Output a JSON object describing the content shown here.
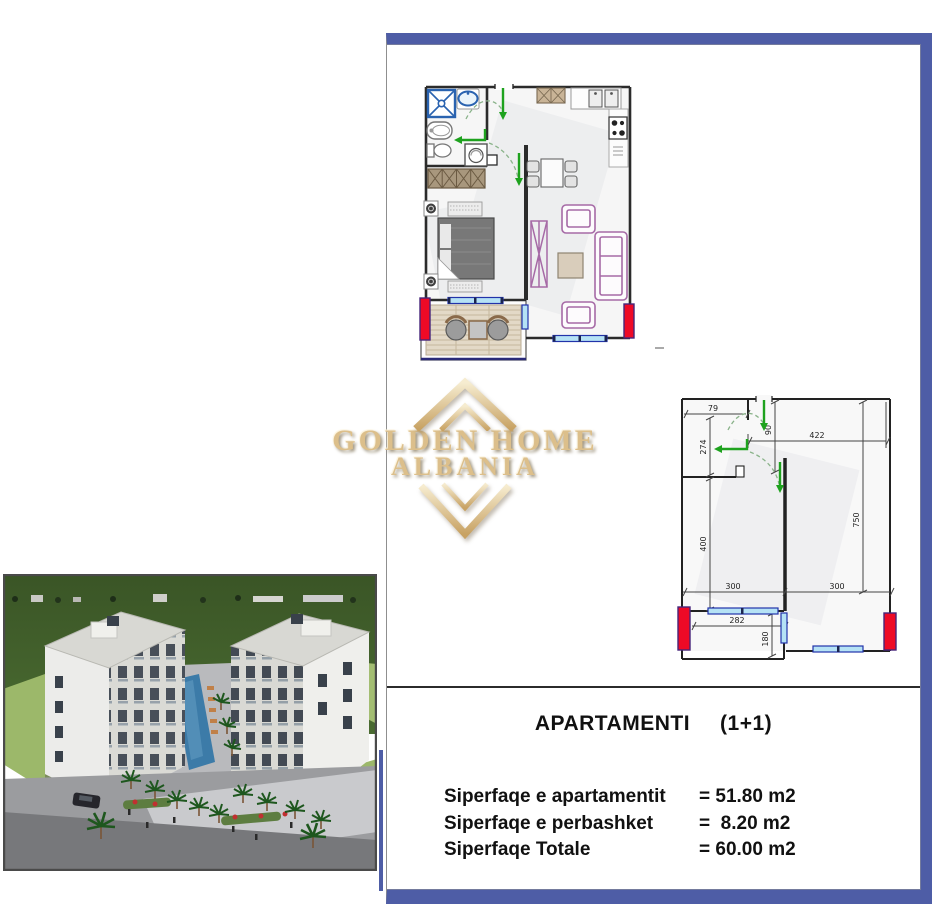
{
  "logo": {
    "line1": "GOLDEN HOME",
    "line2": "ALBANIA",
    "gold_color": "#d9bc85"
  },
  "details": {
    "title": "APARTAMENTI",
    "type": "(1+1)",
    "rows": [
      {
        "label": "Siperfaqe e apartamentit",
        "value": "= 51.80 m2"
      },
      {
        "label": "Siperfaqe e perbashket",
        "value": "=  8.20 m2"
      },
      {
        "label": "Siperfaqe Totale",
        "value": "= 60.00 m2"
      }
    ]
  },
  "plan2": {
    "dims": {
      "d79": "79",
      "d274": "274",
      "d90": "90",
      "d422": "422",
      "d400": "400",
      "d750": "750",
      "d300a": "300",
      "d300b": "300",
      "d282": "282",
      "d180": "180"
    }
  },
  "colors": {
    "border_purple": "#4e5da6",
    "column_red": "#ee0a26",
    "window_blue": "#b5e2f5",
    "arrow_green": "#1ea21e",
    "wall_dark": "#2b2b2b"
  }
}
